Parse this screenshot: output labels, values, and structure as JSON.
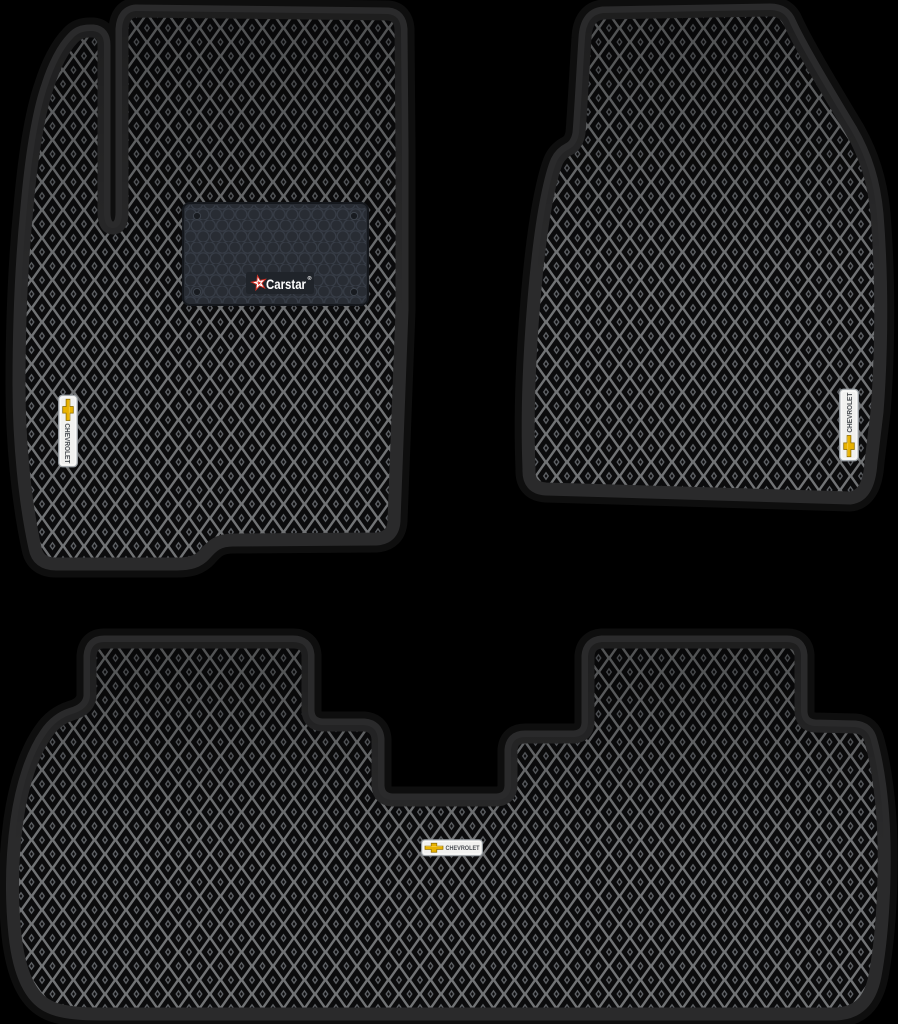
{
  "scene": {
    "type": "product-photo",
    "subject": "Set of three black EVA car floor mats with diamond cells and black edging",
    "background_color": "#000000",
    "items": [
      {
        "label": "front-driver-mat"
      },
      {
        "label": "front-passenger-mat"
      },
      {
        "label": "rear-bench-mat"
      }
    ]
  },
  "branding": {
    "maker_logo_text": "Carstar",
    "maker_logo_reg": "®",
    "car_brand_badge_text": "CHEVROLET"
  },
  "icons": {
    "bowtie": "chevrolet-bowtie-icon",
    "star": "carstar-star-icon",
    "screws": "heel-pad-screw-icon"
  },
  "colors": {
    "background": "#000000",
    "edging": "#2a2a2b",
    "cell_grid_line": "#717375",
    "cell_fill": "#0b0b0c",
    "heel_pad": "#282c33",
    "heel_pad_honeycomb": "#3a404a",
    "badge_background": "#f1f1ef",
    "badge_border": "#9aa0a5",
    "badge_text": "#4a4e53",
    "bowtie_gold": "#e8b200",
    "star_red": "#d93025",
    "logo_text": "#ffffff"
  }
}
